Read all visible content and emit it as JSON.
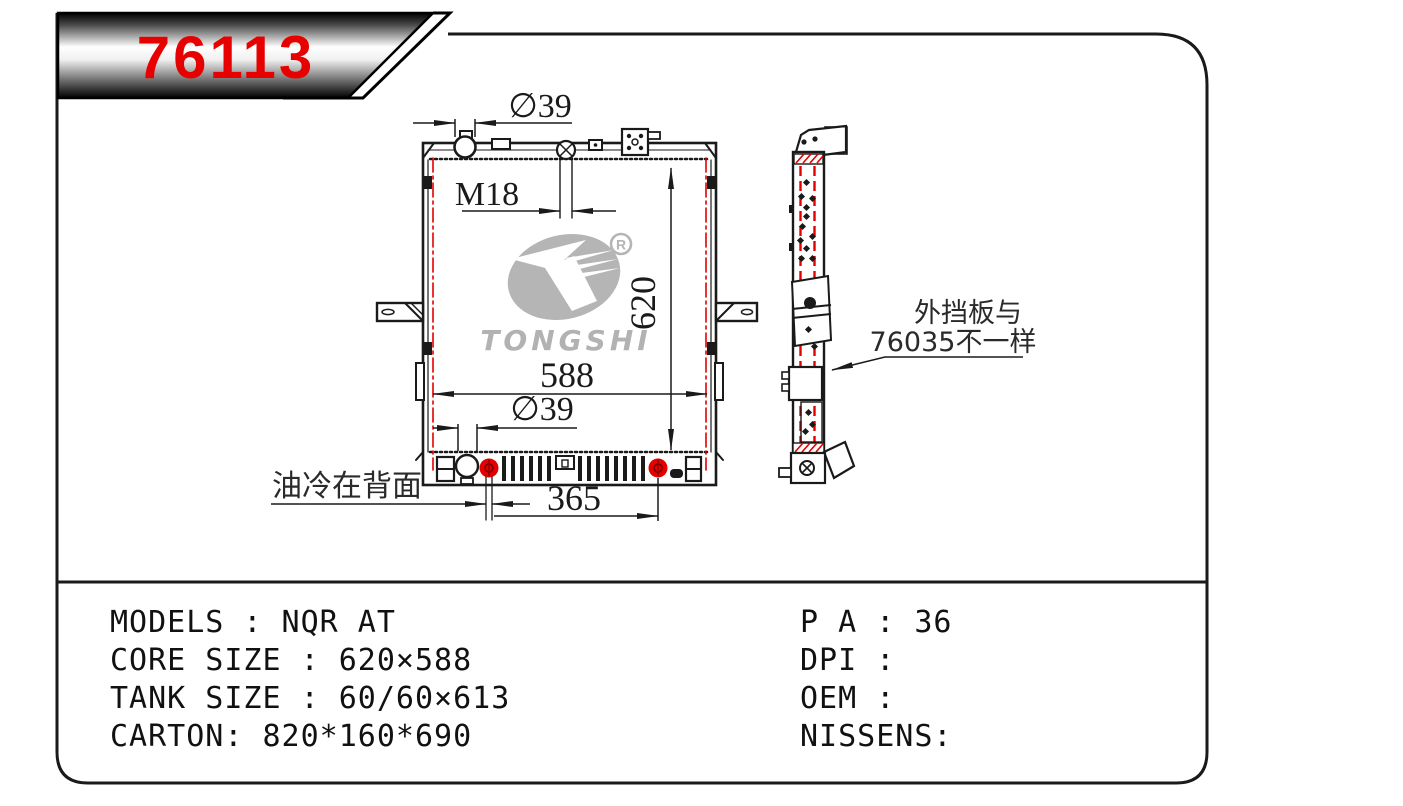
{
  "banner": {
    "part_number": "76113"
  },
  "drawing": {
    "front_view": {
      "dim_filler_diameter": "∅39",
      "dim_drain_thread": "M18",
      "dim_core_height": "620",
      "dim_core_width": "588",
      "dim_outlet_diameter": "∅39",
      "dim_fitting_spacing": "365",
      "note_oil_cooler": "油冷在背面"
    },
    "side_view": {
      "note_baffle_line1": "外挡板与",
      "note_baffle_line2": "76035不一样"
    },
    "logo": {
      "brand": "TONGSHI",
      "registered_mark": "R"
    }
  },
  "specs": {
    "left_lines": [
      "MODELS :  NQR AT",
      "CORE SIZE : 620×588",
      "TANK SIZE : 60/60×613",
      "CARTON: 820*160*690"
    ],
    "right_lines": [
      "P A : 36",
      "DPI :",
      "OEM :",
      "NISSENS:"
    ]
  },
  "colors": {
    "part_number_red": "#e60000",
    "drawing_red": "#e50000",
    "logo_gray": "#b5b5b5",
    "line_black": "#1a1a1a"
  }
}
